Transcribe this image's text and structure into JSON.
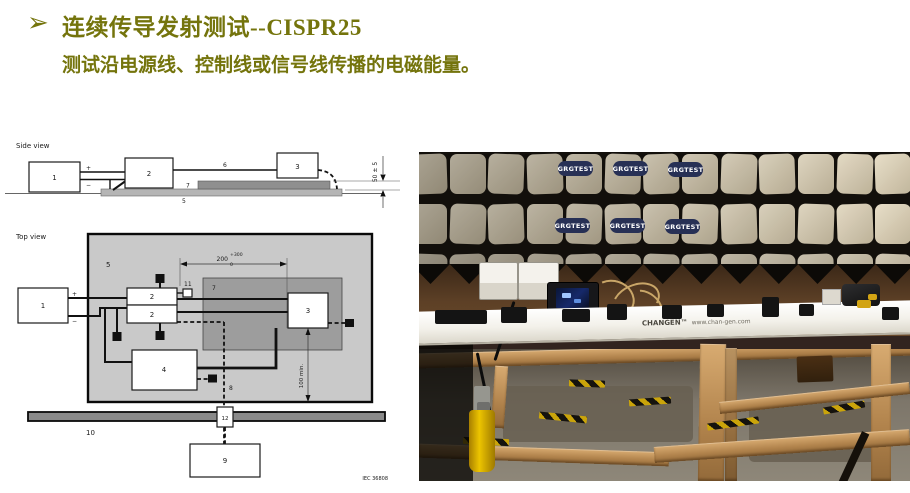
{
  "slide": {
    "bullet_glyph": "➢",
    "title": "连续传导发射测试--CISPR25",
    "subtitle": "测试沿电源线、控制线或信号线传播的电磁能量。",
    "accent_color": "#74740c"
  },
  "diagram": {
    "side": {
      "view_label": "Side view",
      "box1": "1",
      "box2": "2",
      "box3": "3",
      "plus": "+",
      "minus": "−",
      "wire_label": "6",
      "bench_label": "5",
      "plane_label": "7",
      "height_dim": "50 ± 5"
    },
    "top": {
      "view_label": "Top view",
      "box1": "1",
      "box2a": "2",
      "box2b": "2",
      "box3": "3",
      "box4": "4",
      "box9": "9",
      "box12": "12",
      "plus": "+",
      "minus": "−",
      "table_label": "5",
      "plane_label": "7",
      "connector_label": "11",
      "probe_label": "8",
      "strap_label": "10",
      "width_dim": "200",
      "width_tol_plus": "+300",
      "width_tol_minus": "0",
      "clearance_dim": "100 min."
    },
    "figure_ref": "IEC 36808"
  },
  "photo": {
    "absorber_logo": "GRGTEST",
    "bench_brand": "CHANGEN™",
    "bench_url": "www.chan-gen.com"
  }
}
